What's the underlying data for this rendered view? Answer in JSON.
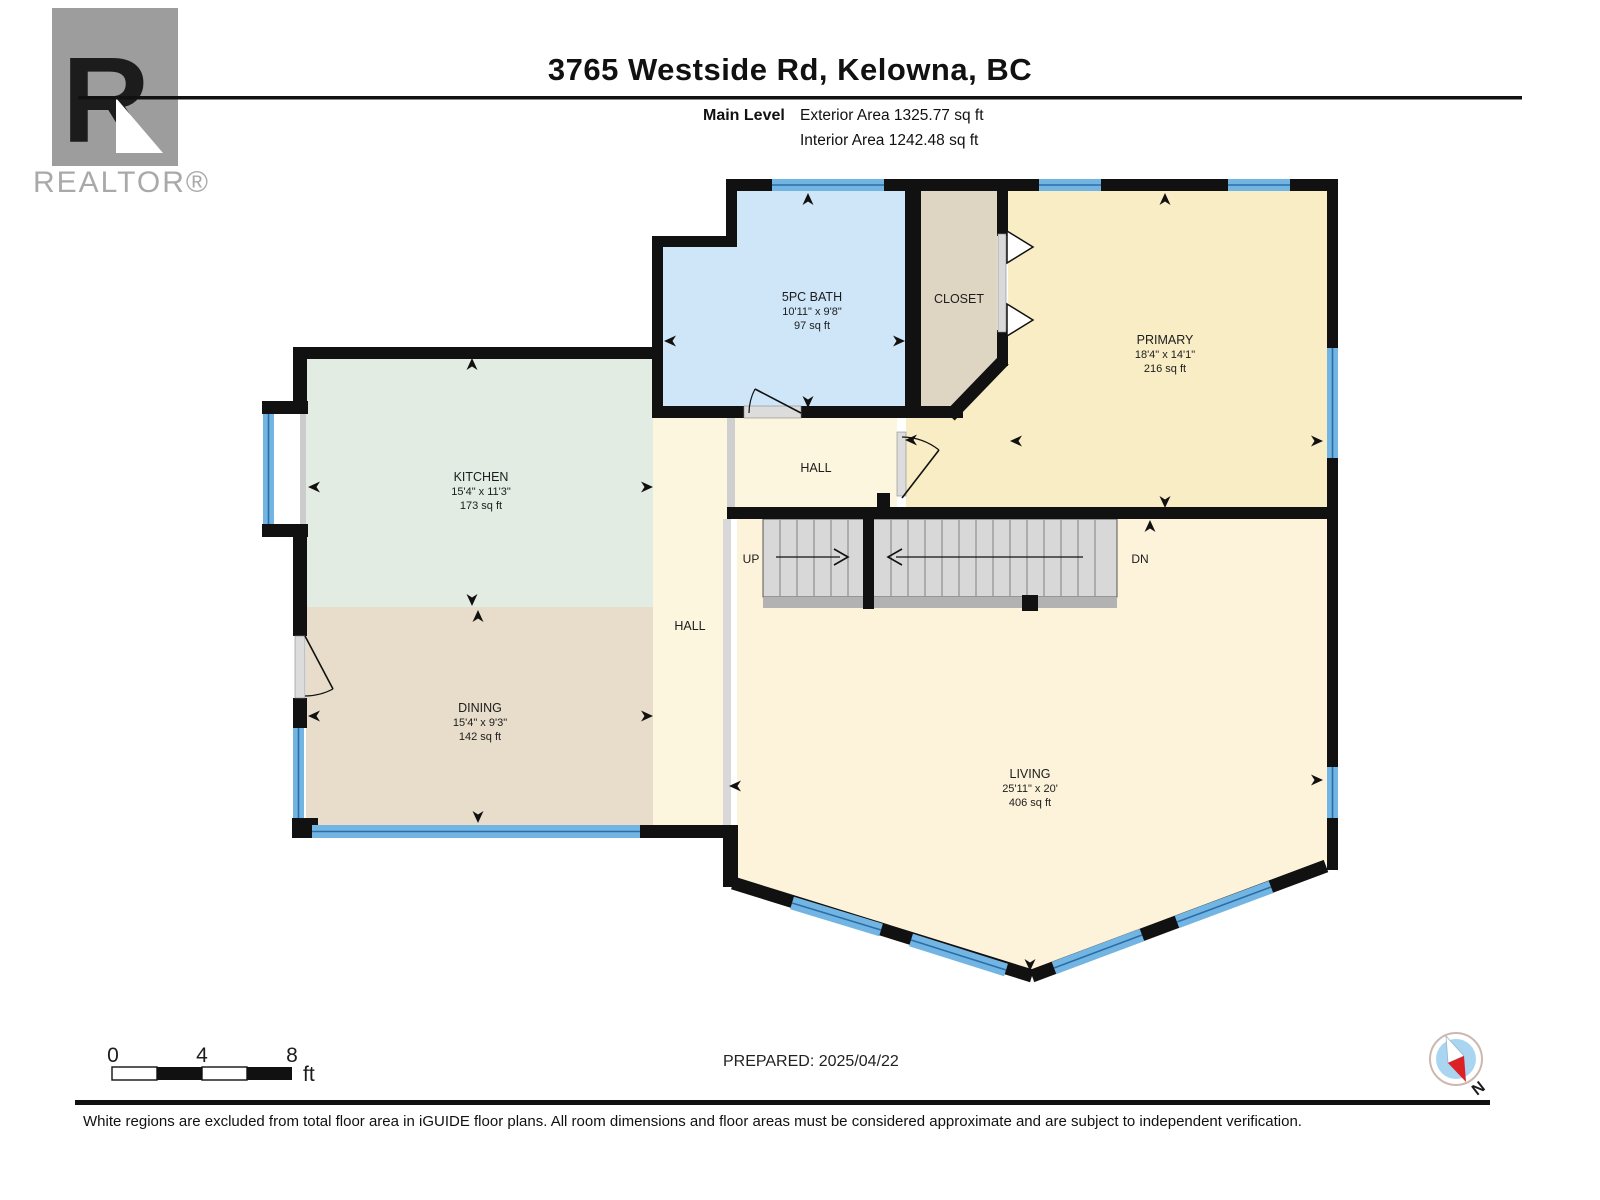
{
  "header": {
    "logo": {
      "letter": "R",
      "wordmark": "REALTOR®"
    },
    "title": "3765 Westside Rd, Kelowna, BC",
    "level_label": "Main Level",
    "exterior_area": "Exterior Area 1325.77 sq ft",
    "interior_area": "Interior Area 1242.48 sq ft"
  },
  "rooms": {
    "bath": {
      "name": "5PC BATH",
      "dims": "10'11\" x 9'8\"",
      "area": "97 sq ft"
    },
    "closet": {
      "name": "CLOSET"
    },
    "primary": {
      "name": "PRIMARY",
      "dims": "18'4\" x 14'1\"",
      "area": "216 sq ft"
    },
    "kitchen": {
      "name": "KITCHEN",
      "dims": "15'4\" x 11'3\"",
      "area": "173 sq ft"
    },
    "dining": {
      "name": "DINING",
      "dims": "15'4\" x 9'3\"",
      "area": "142 sq ft"
    },
    "living": {
      "name": "LIVING",
      "dims": "25'11\" x 20'",
      "area": "406 sq ft"
    },
    "hall_upper": {
      "name": "HALL"
    },
    "hall_corridor": {
      "name": "HALL"
    },
    "stairs": {
      "up": "UP",
      "down": "DN"
    }
  },
  "scale_bar": {
    "tick0": "0",
    "tick4": "4",
    "tick8": "8",
    "unit": "ft"
  },
  "footer": {
    "prepared": "PREPARED: 2025/04/22",
    "compass_north": "N",
    "disclaimer": "White regions are excluded from total floor area in iGUIDE floor plans. All room dimensions and floor areas must be considered approximate and are subject to independent verification."
  },
  "colors": {
    "wall": "#111111",
    "window_blue": "#73b5e2",
    "window_stripe": "#2a6ea8",
    "bath_fill": "#cee6f7",
    "closet_fill": "#ded5c2",
    "primary_fill": "#f9edc6",
    "kitchen_fill": "#e2ece2",
    "dining_fill": "#e7ddca",
    "living_fill": "#fcf3da",
    "hall_fill": "#fdf6df",
    "stairs_fill": "#d8d8d8",
    "compass_red": "#dd1f26"
  }
}
